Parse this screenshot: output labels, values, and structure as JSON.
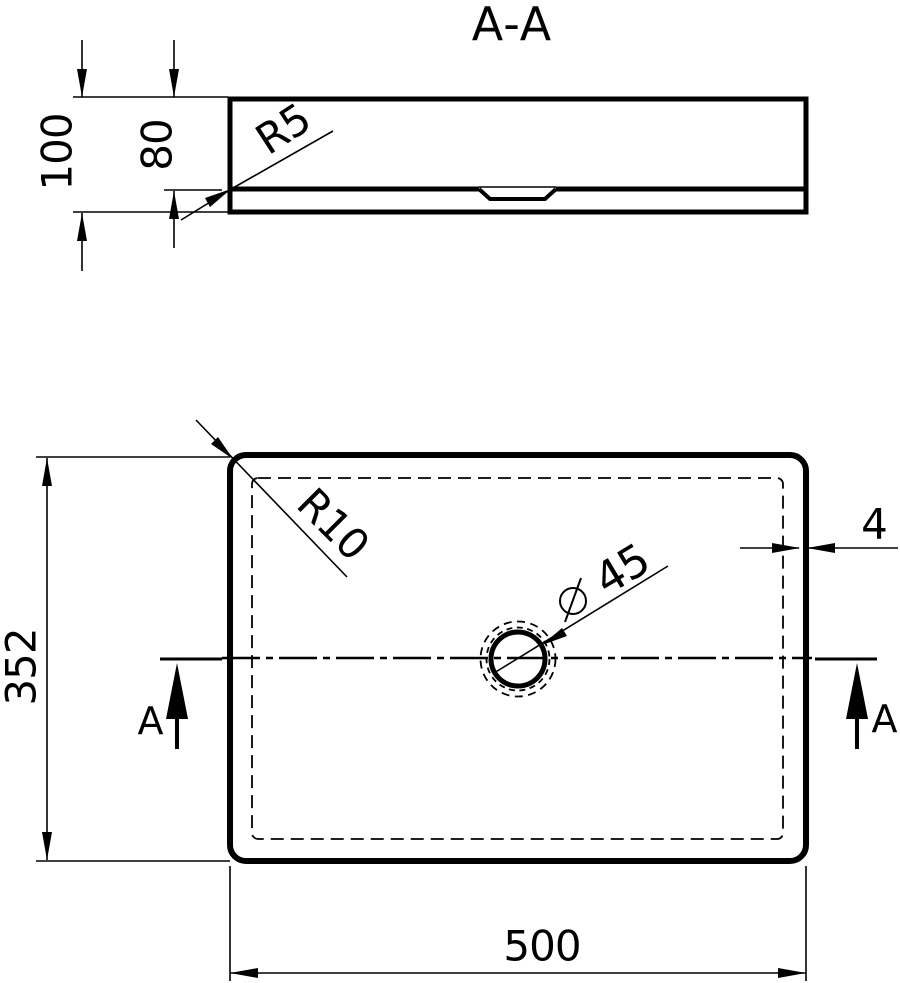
{
  "colors": {
    "ink": "#000000",
    "paper": "#ffffff"
  },
  "section_view": {
    "title": "A-A",
    "dims": {
      "overall_height": "100",
      "basin_inner_depth": "80",
      "bottom_fillet_radius": "R5"
    }
  },
  "plan_view": {
    "dims": {
      "overall_width": "500",
      "overall_depth": "352",
      "corner_radius": "R10",
      "wall_thickness": "4",
      "drain_diameter_symbol": "⌀",
      "drain_diameter_value": "45"
    },
    "cut_line": {
      "left_label": "A",
      "right_label": "A"
    }
  }
}
